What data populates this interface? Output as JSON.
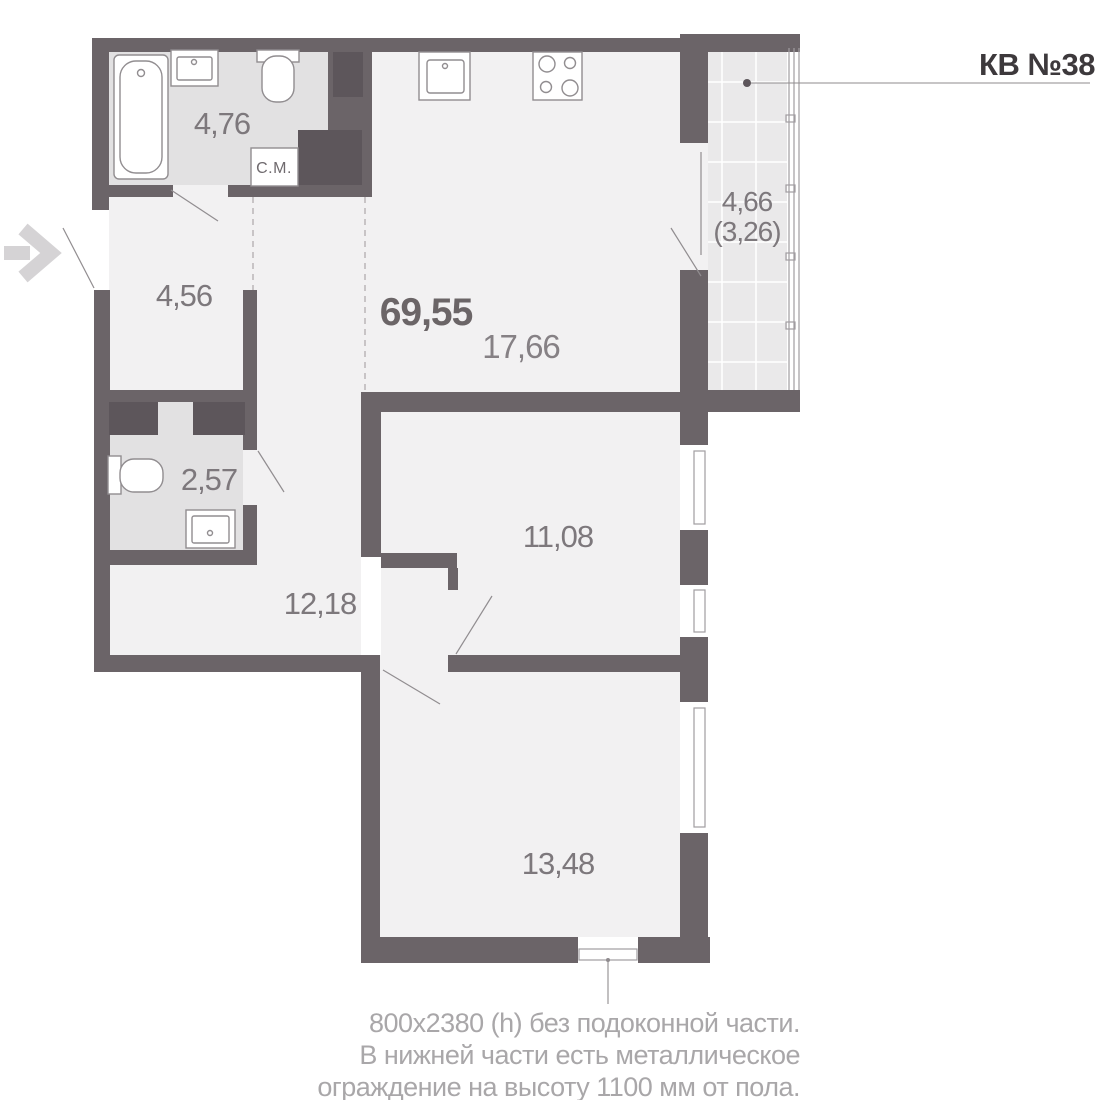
{
  "header": {
    "apartment_label": "КВ №38"
  },
  "rooms": {
    "bathroom": {
      "name": "bathroom",
      "area": "4,76"
    },
    "entry_hall": {
      "name": "entry-hall",
      "area": "4,56"
    },
    "total_area": "69,55",
    "kitchen_living": {
      "name": "kitchen-living",
      "area": "17,66"
    },
    "balcony": {
      "name": "balcony",
      "area": "4,66",
      "area_coeff": "(3,26)"
    },
    "wc": {
      "name": "wc",
      "area": "2,57"
    },
    "hallway": {
      "name": "hallway",
      "area": "12,18"
    },
    "room_1": {
      "name": "room-1",
      "area": "11,08"
    },
    "room_2": {
      "name": "room-2",
      "area": "13,48"
    }
  },
  "fixtures": {
    "washing_machine_label": "С.М.",
    "icons": [
      "entrance-arrow",
      "bathtub",
      "bathroom-sink",
      "toilet",
      "washing-machine",
      "ventilation-shaft",
      "kitchen-sink",
      "stove",
      "wc-toilet",
      "wc-sink",
      "window",
      "balcony-glazing",
      "door-swing"
    ]
  },
  "window_note": {
    "line_1": "800х2380 (h) без подоконной части.",
    "line_2": "В нижней части есть металлическое",
    "line_3": "ограждение на высоту 1100 мм от пола."
  },
  "colors": {
    "wall": "#6b6468",
    "wall_dark": "#5d565b",
    "floor_wet": "#e2e1e2",
    "floor_room": "#f2f1f2",
    "floor_balcony": "#eae9ea",
    "line": "#918d90",
    "text_dark": "#3d393c",
    "text_strong": "#6b6567",
    "text_gray": "#7d787c",
    "text_light": "#a9a7a9",
    "arrow": "#d5d3d5"
  }
}
